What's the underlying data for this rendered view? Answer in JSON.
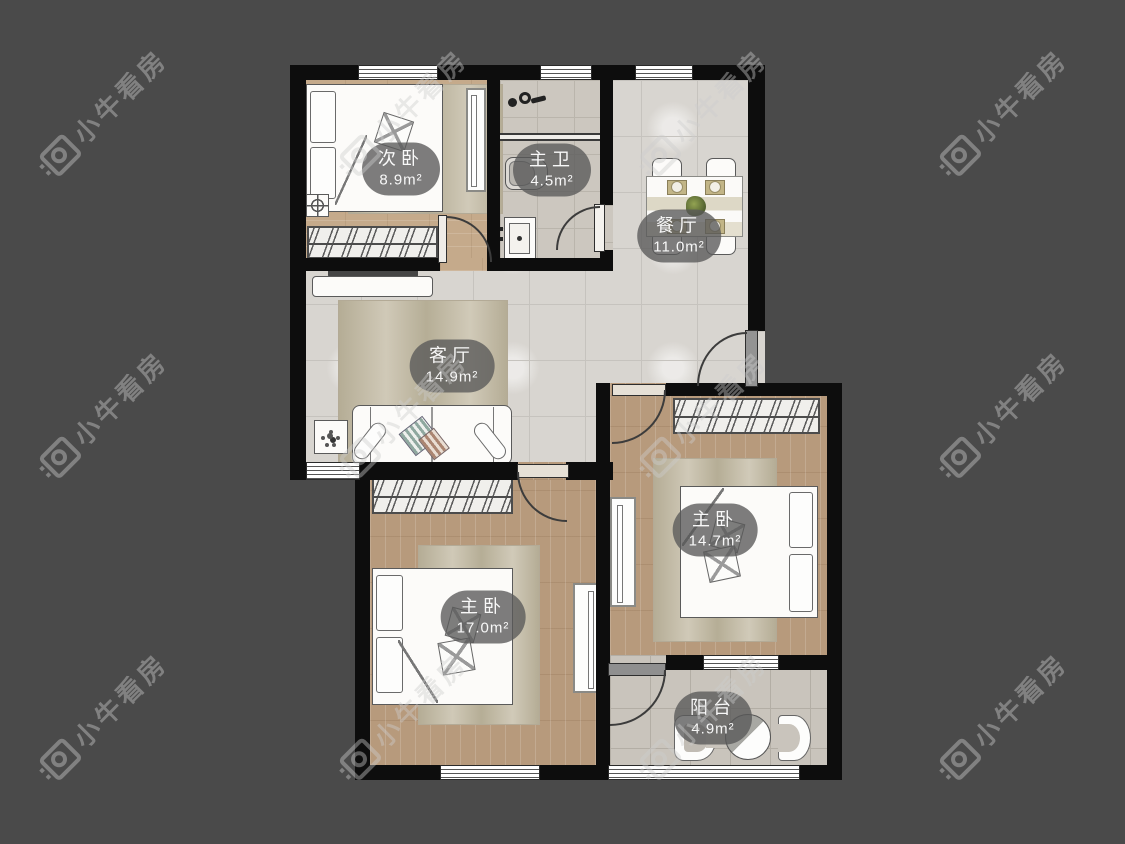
{
  "watermark": {
    "text": "小牛看房"
  },
  "rooms": [
    {
      "id": "secondary-bedroom",
      "name": "次卧",
      "area": "8.9m²"
    },
    {
      "id": "master-bathroom",
      "name": "主卫",
      "area": "4.5m²"
    },
    {
      "id": "dining-room",
      "name": "餐厅",
      "area": "11.0m²"
    },
    {
      "id": "living-room",
      "name": "客厅",
      "area": "14.9m²"
    },
    {
      "id": "master-bedroom-left",
      "name": "主卧",
      "area": "17.0m²"
    },
    {
      "id": "master-bedroom-right",
      "name": "主卧",
      "area": "14.7m²"
    },
    {
      "id": "balcony",
      "name": "阳台",
      "area": "4.9m²"
    }
  ],
  "palette": {
    "background": "#4a4a4a",
    "wall": "#0d0d0d",
    "tile_floor": "#d8d5d0",
    "wood_floor": "#b79a7c",
    "wood_floor_light": "#c5aa8b",
    "bath_tile": "#ccc7bf",
    "balcony_tile": "#c9c4bc",
    "label_bg": "rgba(88,88,88,0.78)",
    "label_text": "#ffffff",
    "watermark_gray": "#6e6e6e"
  }
}
